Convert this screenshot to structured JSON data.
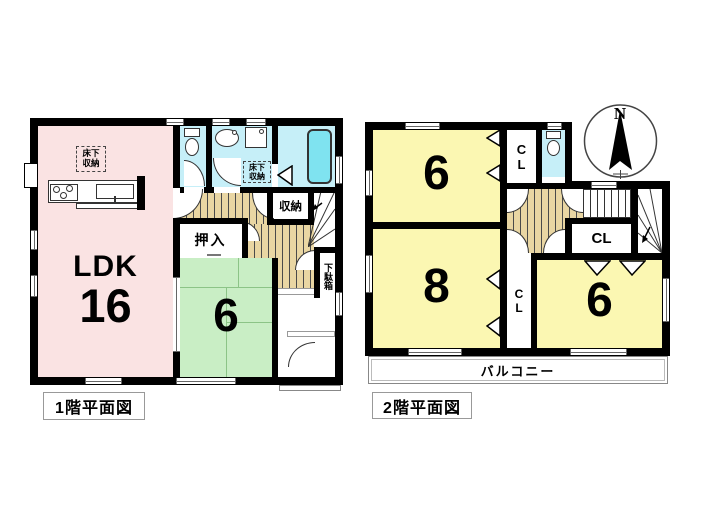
{
  "floor1": {
    "title": "1階平面図",
    "ldk_label": "LDK",
    "ldk_size": "16",
    "tatami_size": "6",
    "oshiire": "押入",
    "storage": "収納",
    "underfloor_kitchen": "床下収納",
    "underfloor_washroom": "床下収納",
    "shoe_cabinet": "下駄箱"
  },
  "floor2": {
    "title": "2階平面図",
    "room_top_left": "6",
    "room_bottom_left": "8",
    "room_bottom_right": "6",
    "closet_top": "CL",
    "closet_mid": "CL",
    "closet_between": "CL",
    "balcony": "バルコニー",
    "compass_north": "N"
  },
  "colors": {
    "wall": "#000000",
    "ldk_pink": "#fae3e3",
    "tatami_green": "#c9eec5",
    "room_yellow": "#fbf7b2",
    "wet_area_cyan": "#c6eff8",
    "bathtub_cyan": "#7fe3f0",
    "floor_tan": "#e9d6a3"
  }
}
